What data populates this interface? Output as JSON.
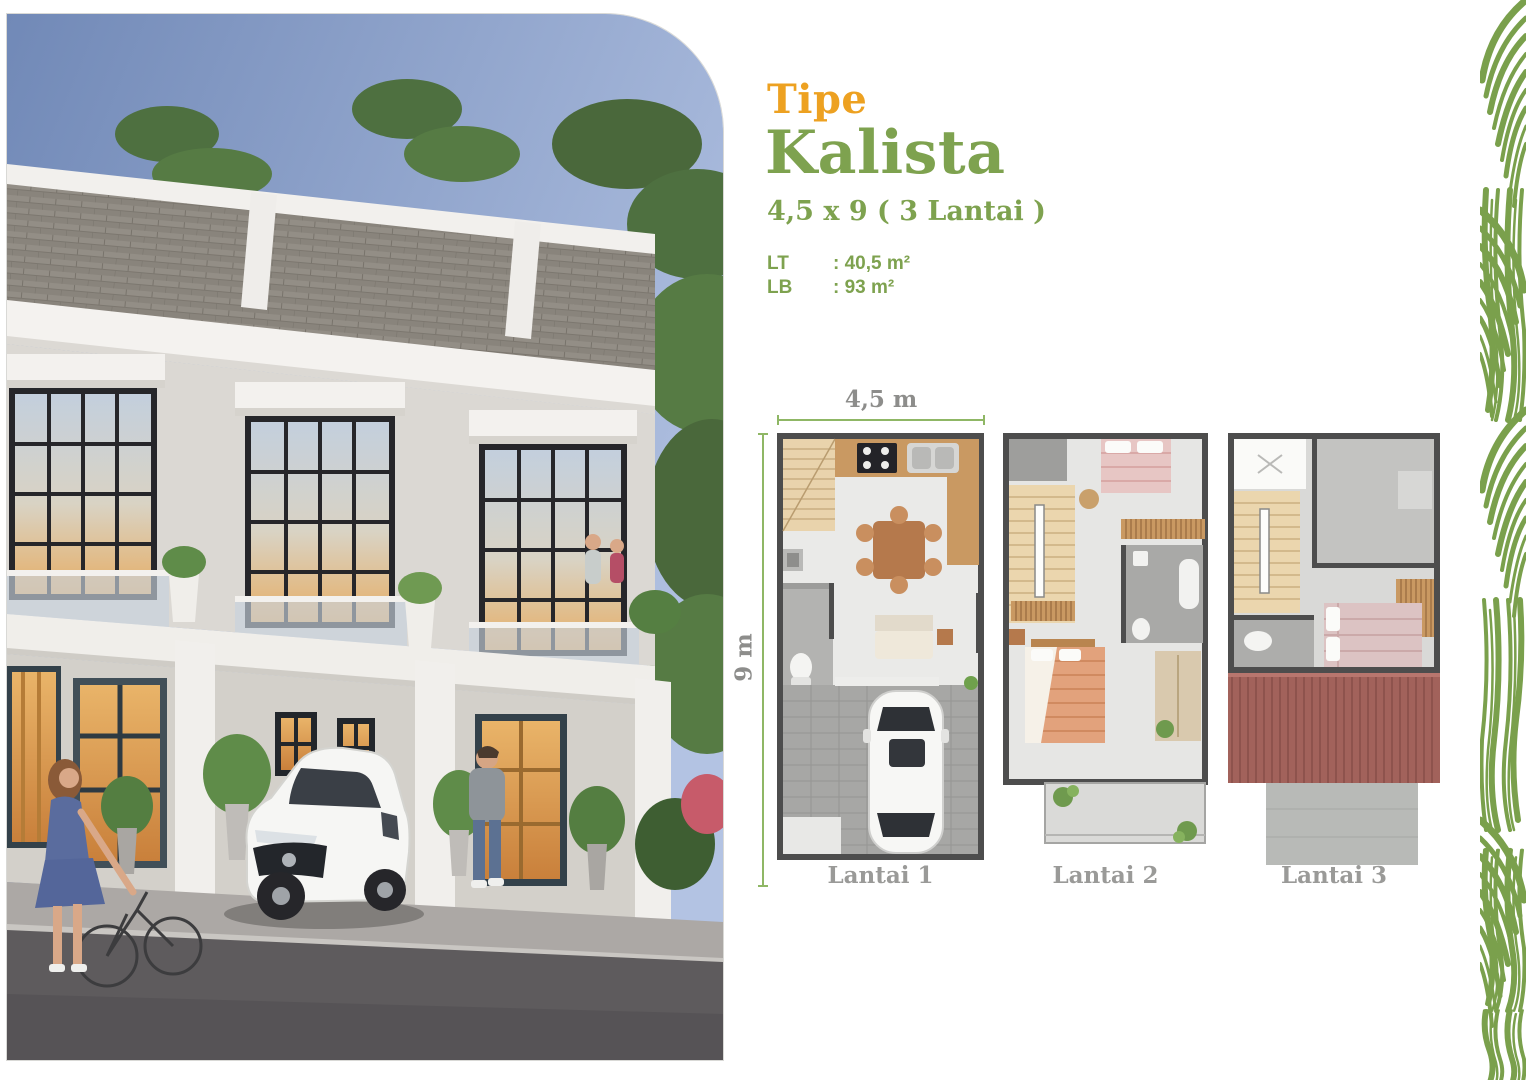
{
  "brochure": {
    "type_label": "Tipe",
    "type_name": "Kalista",
    "dimensions": "4,5 x 9 ( 3 Lantai )",
    "land_area": {
      "label": "LT",
      "value": ": 40,5 m²"
    },
    "building_area": {
      "label": "LB",
      "value": ": 93 m²"
    }
  },
  "floorplans": {
    "width_dimension": "4,5 m",
    "height_dimension": "9 m",
    "floors": [
      {
        "label": "Lantai 1"
      },
      {
        "label": "Lantai 2"
      },
      {
        "label": "Lantai 3"
      }
    ]
  },
  "colors": {
    "accent_orange": "#EDA121",
    "accent_green": "#7EA24F",
    "dimension_line_green": "#8FB765",
    "dimension_text_gray": "#8D8D8B",
    "floor_label_gray": "#9A9A98",
    "leaf_pattern_green": "#7AA04C",
    "plan_wall_gray": "#4D4D4D",
    "roof_deck_red": "#A2625B"
  }
}
